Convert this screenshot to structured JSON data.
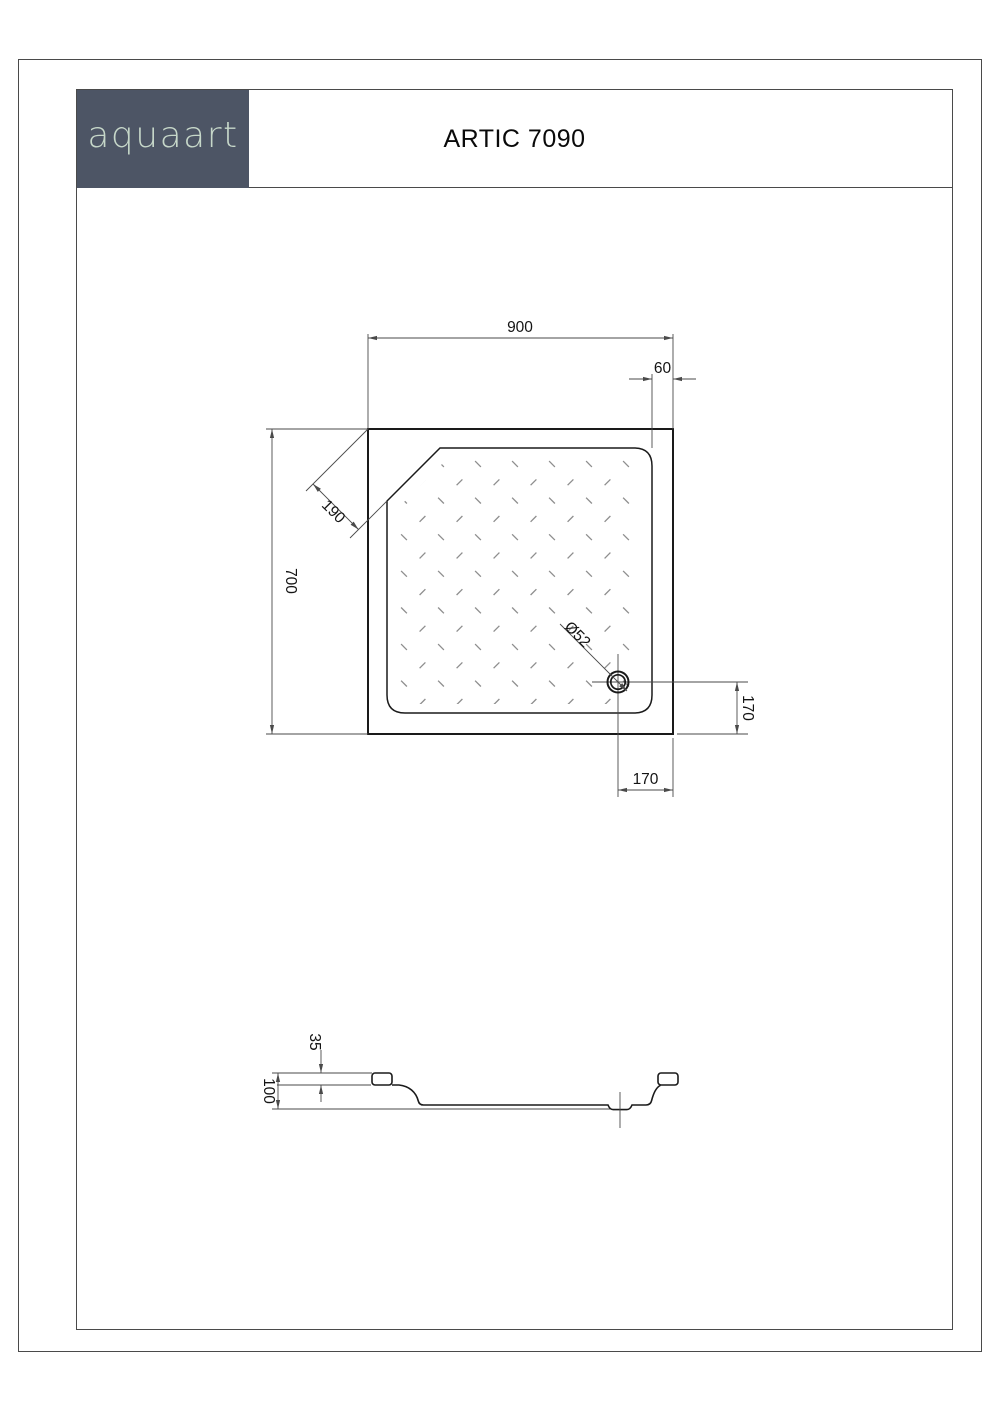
{
  "header": {
    "logo_text": "aquaart",
    "title": "ARTIC 7090"
  },
  "colors": {
    "logo_bg": "#4d5565",
    "logo_text": "#c6d7c9",
    "frame": "#4a4a4a",
    "drawing_line": "#1a1a1a",
    "dim_line": "#4a4a4a",
    "pattern_dash": "#8e8e8e"
  },
  "top_view": {
    "dim_width": "900",
    "dim_rim": "60",
    "dim_corner_cut": "190",
    "dim_depth": "700",
    "drain_diameter": "Ø52",
    "dim_drain_from_side_edge": "170",
    "dim_drain_from_bottom_edge": "170"
  },
  "side_view": {
    "dim_rim_height": "35",
    "dim_total_height": "100"
  }
}
